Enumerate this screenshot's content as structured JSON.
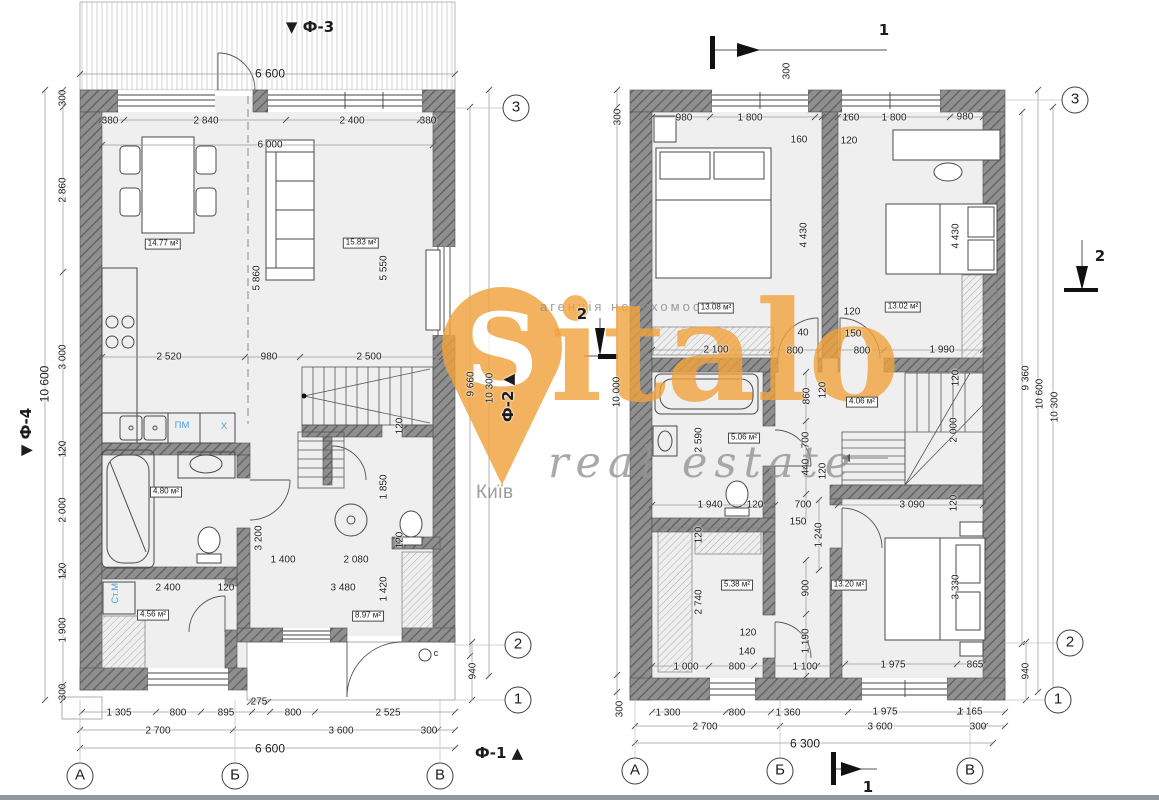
{
  "colors": {
    "wall": "#8f8f8f",
    "wall_hatch": "#5f5f5f",
    "floor": "#efefef",
    "appliance_text": "#4da2d6",
    "watermark_accent": "#F0A23C",
    "watermark_gray": "#9b9b9b",
    "dimension_text": "#1d1d1d"
  },
  "watermark": {
    "agency": "агенція нерухомості",
    "brand_initial": "S",
    "brand_rest": "italo",
    "tagline": "real estate",
    "city": "Київ"
  },
  "left_plan": {
    "labels": [
      {
        "t": "▼ Ф-3",
        "x": 310,
        "y": 27,
        "k": "facade"
      },
      {
        "t": "6 600",
        "x": 270,
        "y": 74,
        "s": 12
      },
      {
        "t": "380",
        "x": 110,
        "y": 121
      },
      {
        "t": "2 840",
        "x": 206,
        "y": 121
      },
      {
        "t": "2 400",
        "x": 352,
        "y": 121
      },
      {
        "t": "380",
        "x": 428,
        "y": 121
      },
      {
        "t": "6 000",
        "x": 270,
        "y": 145
      },
      {
        "t": "300",
        "x": 63,
        "y": 98,
        "k": "dimv"
      },
      {
        "t": "2 860",
        "x": 63,
        "y": 190,
        "k": "dimv"
      },
      {
        "t": "3 000",
        "x": 63,
        "y": 357,
        "k": "dimv"
      },
      {
        "t": "120",
        "x": 63,
        "y": 449,
        "k": "dimv"
      },
      {
        "t": "2 000",
        "x": 63,
        "y": 510,
        "k": "dimv"
      },
      {
        "t": "120",
        "x": 63,
        "y": 571,
        "k": "dimv"
      },
      {
        "t": "1 900",
        "x": 63,
        "y": 630,
        "k": "dimv"
      },
      {
        "t": "300",
        "x": 63,
        "y": 692,
        "k": "dimv"
      },
      {
        "t": "10 600",
        "x": 45,
        "y": 384,
        "k": "dimv",
        "s": 12
      },
      {
        "t": "▼ Ф-4",
        "x": 26,
        "y": 432,
        "k": "facadev"
      },
      {
        "t": "14.77 м²",
        "x": 163,
        "y": 244,
        "k": "area"
      },
      {
        "t": "15.83 м²",
        "x": 361,
        "y": 243,
        "k": "area"
      },
      {
        "t": "5 860",
        "x": 257,
        "y": 278,
        "k": "dimv"
      },
      {
        "t": "5 550",
        "x": 384,
        "y": 268,
        "k": "dimv"
      },
      {
        "t": "2 520",
        "x": 169,
        "y": 357
      },
      {
        "t": "980",
        "x": 269,
        "y": 357
      },
      {
        "t": "2 500",
        "x": 369,
        "y": 357
      },
      {
        "t": "ПМ",
        "x": 182,
        "y": 426,
        "k": "blue"
      },
      {
        "t": "Х",
        "x": 224,
        "y": 427,
        "k": "blue"
      },
      {
        "t": "4.80 м²",
        "x": 166,
        "y": 492,
        "k": "area"
      },
      {
        "t": "120",
        "x": 400,
        "y": 426,
        "k": "dimv"
      },
      {
        "t": "1 850",
        "x": 384,
        "y": 487,
        "k": "dimv"
      },
      {
        "t": "3 200",
        "x": 259,
        "y": 538,
        "k": "dimv"
      },
      {
        "t": "120",
        "x": 400,
        "y": 540,
        "k": "dimv"
      },
      {
        "t": "1 400",
        "x": 283,
        "y": 560
      },
      {
        "t": "2 080",
        "x": 356,
        "y": 560
      },
      {
        "t": "Ст.М.",
        "x": 116,
        "y": 592,
        "k": "bluev"
      },
      {
        "t": "2 400",
        "x": 168,
        "y": 588
      },
      {
        "t": "120",
        "x": 226,
        "y": 588
      },
      {
        "t": "3 480",
        "x": 343,
        "y": 588
      },
      {
        "t": "1 420",
        "x": 384,
        "y": 589,
        "k": "dimv"
      },
      {
        "t": "4.56 м²",
        "x": 153,
        "y": 615,
        "k": "area"
      },
      {
        "t": "8.97 м²",
        "x": 368,
        "y": 616,
        "k": "area"
      },
      {
        "t": "9 660",
        "x": 471,
        "y": 384,
        "k": "dimv"
      },
      {
        "t": "10 300",
        "x": 490,
        "y": 388,
        "k": "dimv"
      },
      {
        "t": "Ф-2 ▲",
        "x": 508,
        "y": 398,
        "k": "facadev"
      },
      {
        "t": "940",
        "x": 473,
        "y": 671,
        "k": "dimv"
      },
      {
        "t": "c",
        "x": 436,
        "y": 654,
        "s": 9
      },
      {
        "t": "275",
        "x": 259,
        "y": 702
      },
      {
        "t": "1 305",
        "x": 119,
        "y": 713
      },
      {
        "t": "800",
        "x": 178,
        "y": 713
      },
      {
        "t": "895",
        "x": 226,
        "y": 713
      },
      {
        "t": "800",
        "x": 293,
        "y": 713
      },
      {
        "t": "2 525",
        "x": 388,
        "y": 713
      },
      {
        "t": "2 700",
        "x": 158,
        "y": 731
      },
      {
        "t": "3 600",
        "x": 341,
        "y": 731
      },
      {
        "t": "300",
        "x": 429,
        "y": 731
      },
      {
        "t": "6 600",
        "x": 270,
        "y": 749,
        "s": 12
      },
      {
        "t": "Ф-1 ▲",
        "x": 499,
        "y": 753,
        "k": "facade"
      },
      {
        "t": "А",
        "x": 80,
        "y": 776,
        "k": "axis"
      },
      {
        "t": "Б",
        "x": 235,
        "y": 776,
        "k": "axis"
      },
      {
        "t": "В",
        "x": 440,
        "y": 776,
        "k": "axis"
      },
      {
        "t": "3",
        "x": 516,
        "y": 108,
        "k": "axis"
      },
      {
        "t": "2",
        "x": 518,
        "y": 645,
        "k": "axis"
      },
      {
        "t": "1",
        "x": 518,
        "y": 700,
        "k": "axis"
      },
      {
        "t": "2",
        "x": 582,
        "y": 314,
        "k": "section"
      }
    ]
  },
  "right_plan": {
    "labels": [
      {
        "t": "1",
        "x": 884,
        "y": 30,
        "k": "section"
      },
      {
        "t": "300",
        "x": 787,
        "y": 71,
        "k": "dimv"
      },
      {
        "t": "980",
        "x": 684,
        "y": 118
      },
      {
        "t": "1 800",
        "x": 750,
        "y": 118
      },
      {
        "t": "160",
        "x": 799,
        "y": 140
      },
      {
        "t": "160",
        "x": 851,
        "y": 118
      },
      {
        "t": "1 800",
        "x": 894,
        "y": 118
      },
      {
        "t": "980",
        "x": 965,
        "y": 117
      },
      {
        "t": "120",
        "x": 849,
        "y": 141
      },
      {
        "t": "300",
        "x": 618,
        "y": 117,
        "k": "dimv"
      },
      {
        "t": "10 000",
        "x": 617,
        "y": 392,
        "k": "dimv"
      },
      {
        "t": "300",
        "x": 620,
        "y": 709,
        "k": "dimv"
      },
      {
        "t": "13.08 м²",
        "x": 716,
        "y": 308,
        "k": "area"
      },
      {
        "t": "13.02 м²",
        "x": 903,
        "y": 307,
        "k": "area"
      },
      {
        "t": "4 430",
        "x": 804,
        "y": 235,
        "k": "dimv"
      },
      {
        "t": "4 430",
        "x": 956,
        "y": 236,
        "k": "dimv"
      },
      {
        "t": "2 100",
        "x": 716,
        "y": 350
      },
      {
        "t": "40",
        "x": 803,
        "y": 333
      },
      {
        "t": "800",
        "x": 795,
        "y": 351
      },
      {
        "t": "150",
        "x": 853,
        "y": 334
      },
      {
        "t": "120",
        "x": 852,
        "y": 312
      },
      {
        "t": "800",
        "x": 862,
        "y": 351
      },
      {
        "t": "1 990",
        "x": 942,
        "y": 350
      },
      {
        "t": "860",
        "x": 807,
        "y": 396,
        "k": "dimv"
      },
      {
        "t": "120",
        "x": 823,
        "y": 390,
        "k": "dimv"
      },
      {
        "t": "120",
        "x": 956,
        "y": 378,
        "k": "dimv"
      },
      {
        "t": "2 000",
        "x": 954,
        "y": 430,
        "k": "dimv"
      },
      {
        "t": "5.06 м²",
        "x": 744,
        "y": 438,
        "k": "area"
      },
      {
        "t": "2 590",
        "x": 699,
        "y": 440,
        "k": "dimv"
      },
      {
        "t": "4.06 м²",
        "x": 862,
        "y": 402,
        "k": "area"
      },
      {
        "t": "700",
        "x": 806,
        "y": 440,
        "k": "dimv"
      },
      {
        "t": "440",
        "x": 806,
        "y": 467,
        "k": "dimv"
      },
      {
        "t": "120",
        "x": 823,
        "y": 471,
        "k": "dimv"
      },
      {
        "t": "1 940",
        "x": 710,
        "y": 505
      },
      {
        "t": "120",
        "x": 755,
        "y": 505
      },
      {
        "t": "700",
        "x": 803,
        "y": 505
      },
      {
        "t": "150",
        "x": 798,
        "y": 522
      },
      {
        "t": "3 090",
        "x": 912,
        "y": 505
      },
      {
        "t": "120",
        "x": 954,
        "y": 503,
        "k": "dimv"
      },
      {
        "t": "1 240",
        "x": 819,
        "y": 535,
        "k": "dimv"
      },
      {
        "t": "120",
        "x": 699,
        "y": 535,
        "k": "dimv"
      },
      {
        "t": "5.38 м²",
        "x": 737,
        "y": 585,
        "k": "area"
      },
      {
        "t": "2 740",
        "x": 699,
        "y": 602,
        "k": "dimv"
      },
      {
        "t": "900",
        "x": 806,
        "y": 588,
        "k": "dimv"
      },
      {
        "t": "13.20 м²",
        "x": 849,
        "y": 585,
        "k": "area"
      },
      {
        "t": "3 330",
        "x": 956,
        "y": 587,
        "k": "dimv"
      },
      {
        "t": "120",
        "x": 748,
        "y": 633
      },
      {
        "t": "140",
        "x": 747,
        "y": 652
      },
      {
        "t": "1 190",
        "x": 806,
        "y": 641,
        "k": "dimv"
      },
      {
        "t": "1 000",
        "x": 686,
        "y": 667
      },
      {
        "t": "800",
        "x": 737,
        "y": 667
      },
      {
        "t": "1 100",
        "x": 805,
        "y": 667
      },
      {
        "t": "1 975",
        "x": 893,
        "y": 665
      },
      {
        "t": "865",
        "x": 975,
        "y": 665
      },
      {
        "t": "940",
        "x": 1026,
        "y": 671,
        "k": "dimv"
      },
      {
        "t": "9 360",
        "x": 1026,
        "y": 378,
        "k": "dimv"
      },
      {
        "t": "10 600",
        "x": 1040,
        "y": 394,
        "k": "dimv"
      },
      {
        "t": "10 300",
        "x": 1055,
        "y": 407,
        "k": "dimv"
      },
      {
        "t": "2",
        "x": 1100,
        "y": 256,
        "k": "section"
      },
      {
        "t": "1 300",
        "x": 668,
        "y": 713
      },
      {
        "t": "800",
        "x": 737,
        "y": 713
      },
      {
        "t": "1 360",
        "x": 788,
        "y": 713
      },
      {
        "t": "1 975",
        "x": 885,
        "y": 712
      },
      {
        "t": "1 165",
        "x": 970,
        "y": 712
      },
      {
        "t": "2 700",
        "x": 705,
        "y": 727
      },
      {
        "t": "3 600",
        "x": 880,
        "y": 727
      },
      {
        "t": "300",
        "x": 978,
        "y": 727
      },
      {
        "t": "6 300",
        "x": 805,
        "y": 744,
        "s": 12
      },
      {
        "t": "1",
        "x": 868,
        "y": 787,
        "k": "section"
      },
      {
        "t": "А",
        "x": 635,
        "y": 771,
        "k": "axis"
      },
      {
        "t": "Б",
        "x": 780,
        "y": 771,
        "k": "axis"
      },
      {
        "t": "В",
        "x": 970,
        "y": 771,
        "k": "axis"
      },
      {
        "t": "3",
        "x": 1075,
        "y": 100,
        "k": "axis"
      },
      {
        "t": "2",
        "x": 1070,
        "y": 643,
        "k": "axis"
      },
      {
        "t": "1",
        "x": 1058,
        "y": 700,
        "k": "axis"
      }
    ]
  }
}
